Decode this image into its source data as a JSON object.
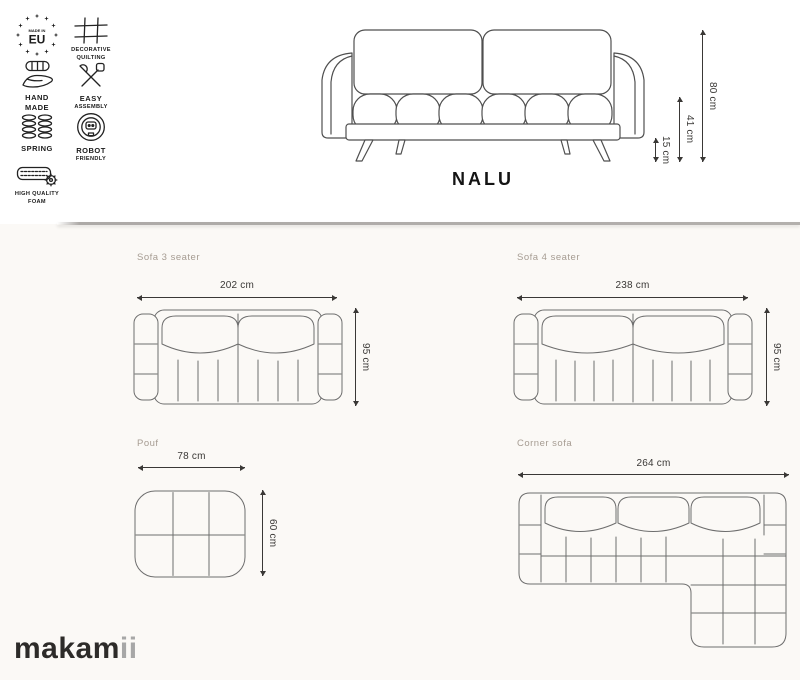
{
  "product": {
    "name": "NALU"
  },
  "brand": {
    "logo_main": "makam",
    "logo_accent": "ii"
  },
  "badges": {
    "made_in_eu": {
      "top": "MADE IN",
      "main": "EU"
    },
    "quilting": {
      "line1": "DECORATIVE",
      "line2": "QUILTING"
    },
    "hand_made": {
      "line1": "HAND",
      "line2": "MADE"
    },
    "easy_assembly": {
      "line1": "EASY",
      "line2": "ASSEMBLY"
    },
    "spring": {
      "line1": "SPRING"
    },
    "robot": {
      "line1": "ROBOT",
      "line2": "FRIENDLY"
    },
    "foam": {
      "line1": "HIGH QUALITY",
      "line2": "FOAM"
    }
  },
  "front_view": {
    "height_total": "80 cm",
    "height_seat": "41 cm",
    "height_legs": "15 cm"
  },
  "variants": {
    "sofa3": {
      "name": "Sofa 3 seater",
      "width": "202 cm",
      "depth": "95 cm"
    },
    "sofa4": {
      "name": "Sofa 4 seater",
      "width": "238 cm",
      "depth": "95 cm"
    },
    "pouf": {
      "name": "Pouf",
      "width": "78 cm",
      "depth": "60 cm"
    },
    "corner": {
      "name": "Corner sofa",
      "width": "264 cm"
    }
  },
  "colors": {
    "background_top": "#ffffff",
    "background_bottom": "#fbf9f6",
    "divider": "#b3b0ad",
    "variant_label": "#a69c92",
    "dimension_text": "#3a3836",
    "line_art": "#4f4f4f",
    "logo_main": "#2d2b29",
    "logo_accent": "#a7a7a7"
  }
}
